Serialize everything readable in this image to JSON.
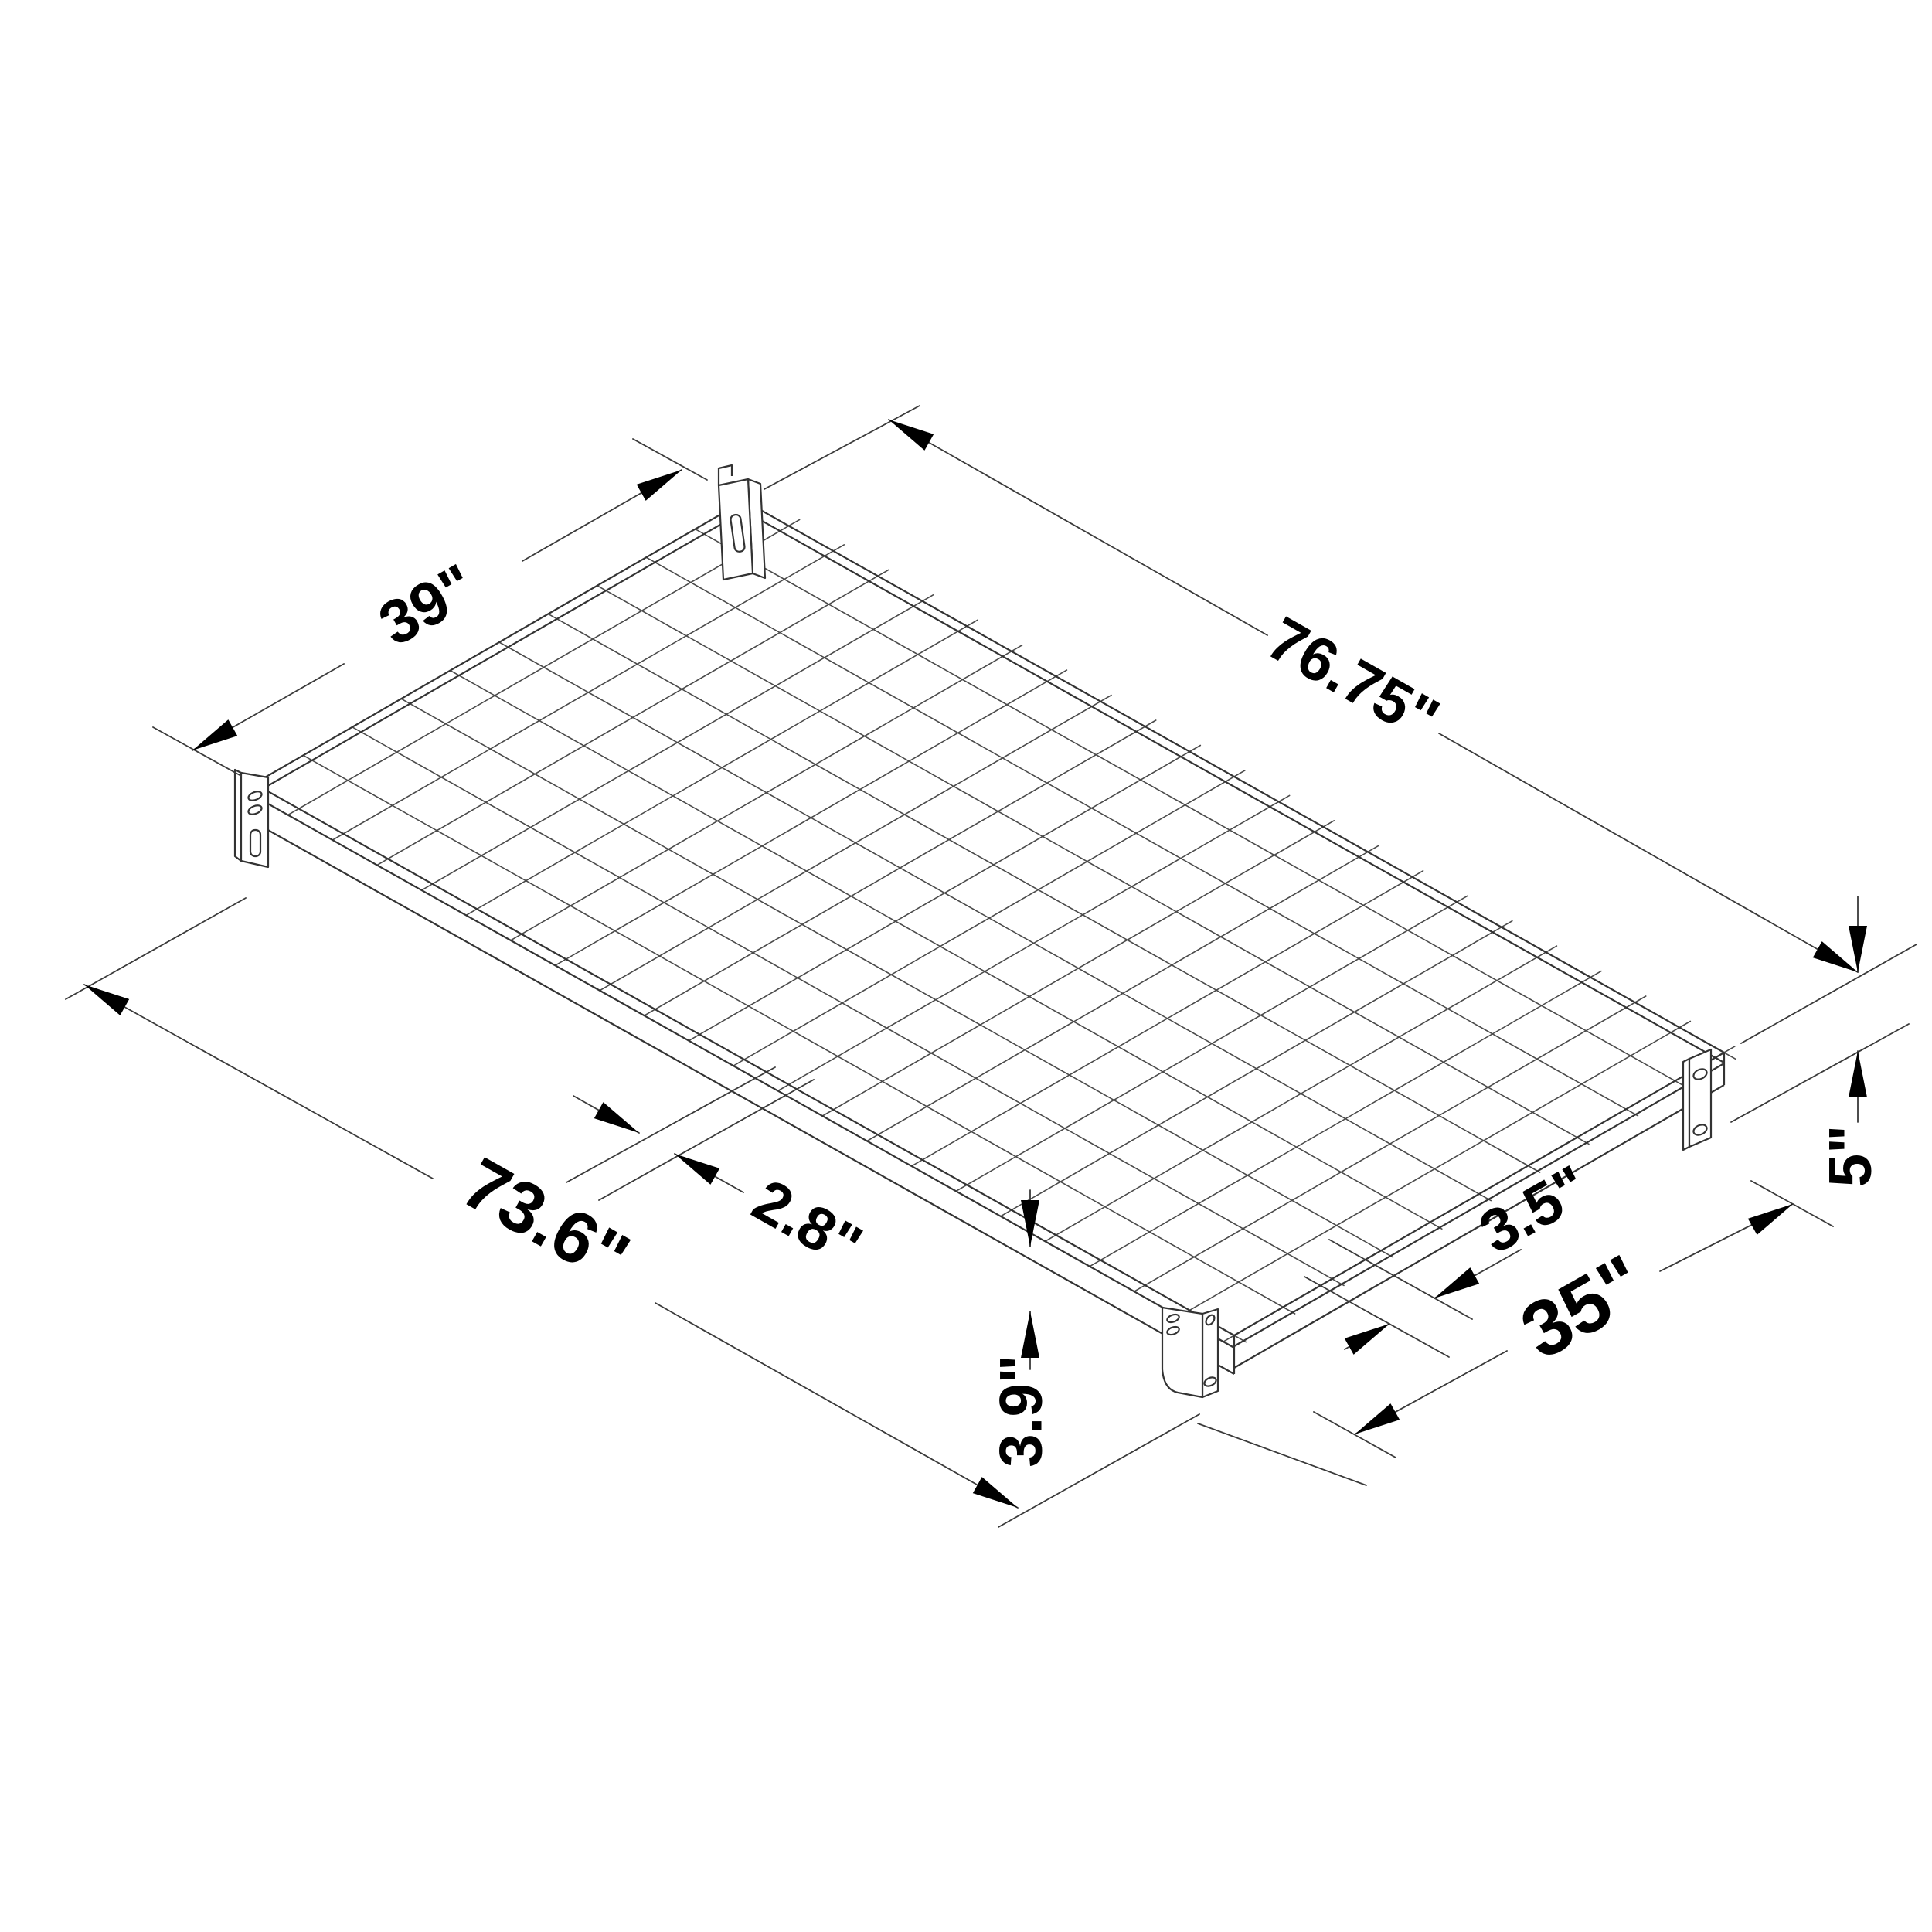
{
  "page": {
    "background": "#ffffff",
    "line_color": "#3a3a3a",
    "mesh_color": "#4a4a4a",
    "text_color": "#000000"
  },
  "diagram": {
    "type": "isometric dimension line-drawing",
    "subject": "wire-grid wall shelf with mounting brackets",
    "labels": {
      "top_width": "39\"",
      "top_length": "76.75\"",
      "front_length": "73.6\"",
      "rail_height": "2.8\"",
      "bracket_offset": "3.5\"",
      "inner_width": "35\"",
      "leg_height": "3.9\"",
      "side_height": "5\""
    }
  }
}
